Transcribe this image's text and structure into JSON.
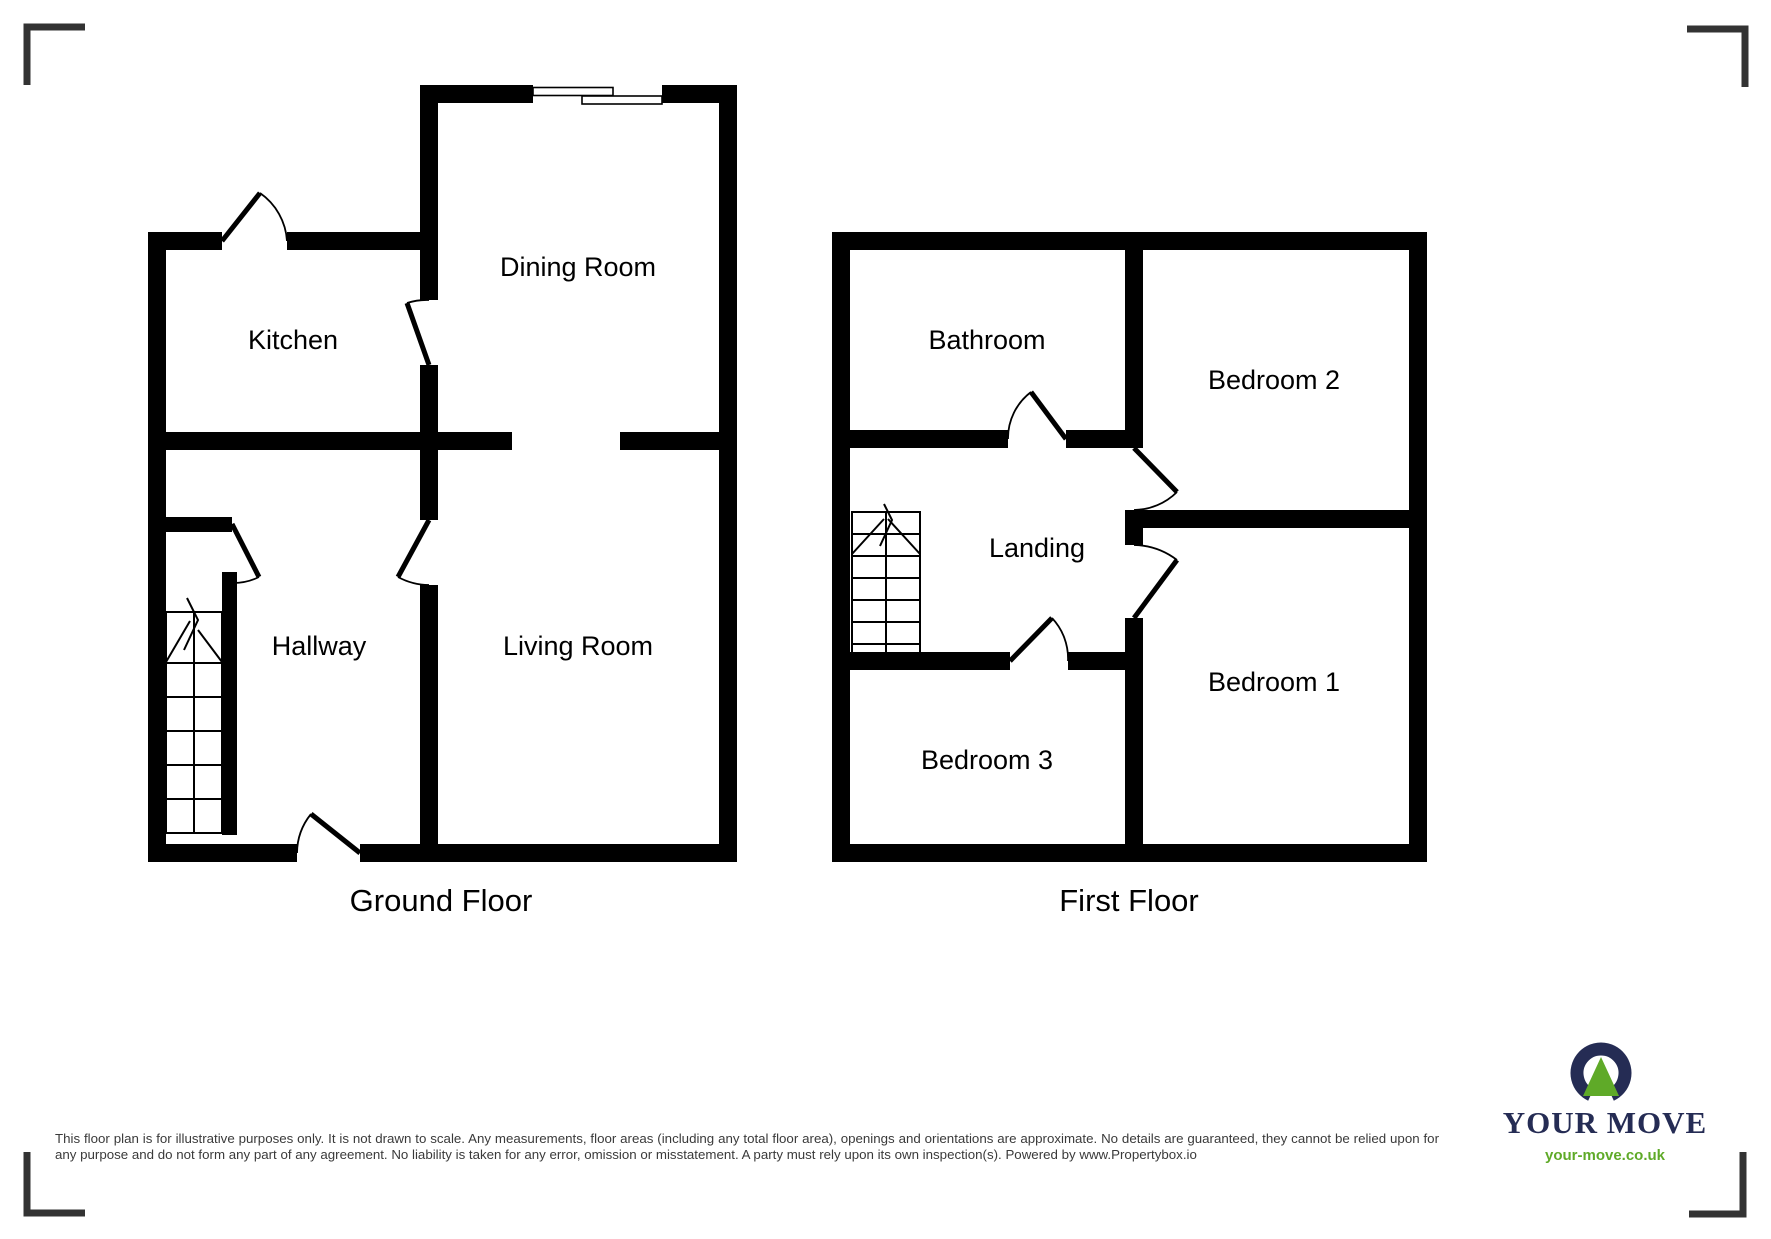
{
  "floors": [
    {
      "title": "Ground Floor",
      "rooms": [
        {
          "label": "Kitchen"
        },
        {
          "label": "Dining Room"
        },
        {
          "label": "Hallway"
        },
        {
          "label": "Living Room"
        }
      ]
    },
    {
      "title": "First Floor",
      "rooms": [
        {
          "label": "Bathroom"
        },
        {
          "label": "Bedroom 2"
        },
        {
          "label": "Landing"
        },
        {
          "label": "Bedroom 1"
        },
        {
          "label": "Bedroom 3"
        }
      ]
    }
  ],
  "disclaimer": "This floor plan is for illustrative purposes only. It is not drawn to scale. Any measurements, floor areas (including any total floor area), openings and orientations are approximate. No details are guaranteed, they cannot be relied upon for any purpose and do not form any part of any agreement. No liability is taken for any error, omission or misstatement. A party must rely upon its own inspection(s). Powered by www.Propertybox.io",
  "logo": {
    "brand": "YOUR MOVE",
    "website": "your-move.co.uk",
    "navy": "#252c54",
    "green": "#5faa28"
  },
  "colors": {
    "wall": "#000000",
    "corner_mark": "#333333",
    "disclaimer_text": "#3a3a3a"
  }
}
